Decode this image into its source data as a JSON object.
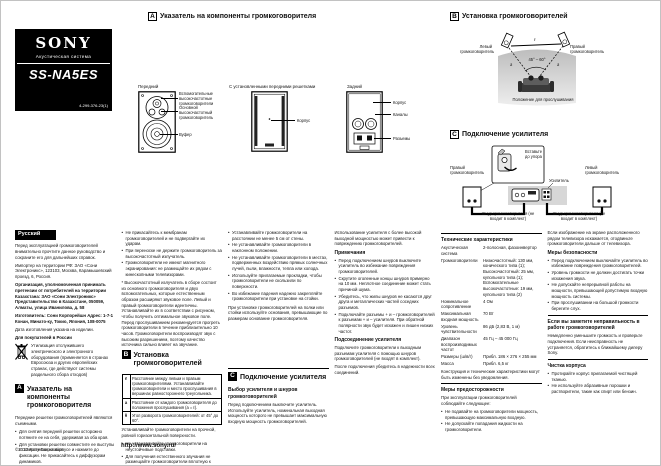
{
  "brand": {
    "logo": "SONY",
    "subtitle": "Акустическая система",
    "model": "SS-NA5ES",
    "part_number": "4-299-376-23(1)"
  },
  "sections": {
    "a": {
      "letter": "A",
      "title": "Указатель на компоненты громкоговорителя"
    },
    "b": {
      "letter": "B",
      "title": "Установка громкоговорителей"
    },
    "c": {
      "letter": "C",
      "title": "Подключение усилителя"
    }
  },
  "diagram_a": {
    "front_caption": "Передний",
    "grille_caption": "С установленными передними решетками",
    "rear_caption": "Задний",
    "label_assist": "Вспомогательные высокочастотные громкоговорители",
    "label_main": "Основной высокочастотный громкоговоритель",
    "label_woofer": "Вуфер",
    "label_cabinet": "Корпус",
    "label_cabinet_rear": "Корпус",
    "label_ducts": "Каналы",
    "label_terminals": "Разъемы"
  },
  "diagram_b": {
    "left_speaker": "Левый громкоговоритель",
    "right_speaker": "Правый громкоговоритель",
    "dist_label": "ℓ",
    "a1": "a",
    "a2": "a",
    "angle": "45° – 60°",
    "caption": "Положение для прослушивания"
  },
  "diagram_c": {
    "left_speaker": "Правый громкоговоритель",
    "right_speaker": "Левый громкоговоритель",
    "amp_label": "Усилитель",
    "inset_label": "Вставьте до упора",
    "cord_left": "Шнур громкоговорителя (не входит в комплект)",
    "cord_right": "Шнур громкоговорителя (не входит в комплект)"
  },
  "col1": {
    "lang": "Русский",
    "p1": "Перед эксплуатацией громкоговорителей внимательно прочтите данное руководство и сохраните его для дальнейших справок.",
    "p2": "Импортер на территории РФ: ЗАО «Сони Электроникс», 123103, Москва, Карамышевский проезд, 6, Россия.",
    "kz": "Организация, уполномоченная принимать претензии от потребителей на территории Казахстана: ЗАО «Сони Электроникс» Представительство в Казахстане, 050059, Алматы, улица Иванилова, д. 58",
    "maker": "Изготовитель: Сони Корпорейшн Адрес: 1-7-1 Конан, Минато-ку, Токио, Япония, 108-0075",
    "made": "Дата изготовления указана на изделии.",
    "russia": "Для покупателей в России",
    "weee": "Утилизация отслужившего электрического и электронного оборудования (применяется в странах Евросоюза и других европейских странах, где действуют системы раздельного сбора отходов)",
    "a_intro": "Передние решетки громкоговорителей являются съемными.",
    "bullets": [
      "Для снятия передней решетки осторожно потяните ее на себя, удерживая за оба края.",
      "Для установки решетки совместите ее выступы с отверстиями на корпусе и нажмите до фиксации. Не прикасайтесь к диффузорам динамиков."
    ]
  },
  "col2": {
    "bullets": [
      "Не прикасайтесь к мембранам громкоговорителей и не подвергайте их ударам.",
      "При переноске не держите громкоговоритель за высокочастотный излучатель.",
      "Громкоговорители не имеют магнитного экранирования: не размещайте их рядом с кинескопными телевизорами."
    ],
    "footnote": "* Высокочастотный излучатель в сборе состоит из основного громкоговорителя и двух вспомогательных, которые естественным образом расширяют звуковое поле. Левый и правый громкоговорители идентичны. Устанавливайте их в соответствии с рисунком, чтобы получить оптимальное звуковое поле. Перед прослушиванием рекомендуется прогреть громкоговорители в течение приблизительно 10 часов. Громкоговорители воспроизводят звук с высоким разрешением, поэтому качество источника сильно влияет на звучание.",
    "table": [
      {
        "key": "ℓ",
        "text": "Расстояние между левым и правым громкоговорителями. Устанавливайте громкоговорители и место прослушивания в вершинах равностороннего треугольника."
      },
      {
        "key": "a",
        "text": "Расстояние от каждого громкоговорителя до положения прослушивания (a = ℓ)."
      },
      {
        "key": "θ",
        "text": "Угол разворота громкоговорителей: от 45° до 60°."
      }
    ],
    "after": "Устанавливайте громкоговорители на прочной, ровной горизонтальной поверхности.",
    "after_bullets": [
      "Не устанавливайте громкоговорители на неустойчивые подставки.",
      "Для получения естественного звучания не размещайте громкоговорители вплотную к стенам и углам комнаты."
    ]
  },
  "col3": {
    "bullets": [
      "Устанавливайте громкоговорители на расстоянии не менее 5 см от стены.",
      "Не устанавливайте громкоговорители в наклонном положении.",
      "Не устанавливайте громкоговорители в местах, подверженных воздействию прямых солнечных лучей, пыли, влажности, тепла или холода.",
      "Используйте прилагаемые прокладки, чтобы громкоговорители не скользили по поверхности.",
      "Во избежание падения надежно закрепляйте громкоговорители при установке на стойки."
    ],
    "para": "При установке громкоговорителей на полки или стойки используйте основания, превышающие по размерам основание громкоговорителя.",
    "sub1": "Выбор усилителя и шнуров громкоговорителей",
    "sub1_text": "Перед подключением выключите усилитель. Используйте усилитель, номинальная выходная мощность которого не превышает максимальную входную мощность громкоговорителей."
  },
  "col4": {
    "p1": "Использование усилителя с более высокой выходной мощностью может привести к повреждению громкоговорителей.",
    "notes_head": "Примечания",
    "notes": [
      "Перед подключением шнуров выключите усилитель во избежание повреждения громкоговорителей.",
      "Скрутите оголенные концы шнуров примерно на 10 мм. Неплотное соединение может стать причиной шума.",
      "Убедитесь, что жилы шнуров не касаются друг друга и металлических частей соседних разъемов.",
      "Подключайте разъемы + и – громкоговорителей к разъемам + и – усилителя. При обратной полярности звук будет искажен и лишен низких частот."
    ],
    "sub2": "Подсоединение усилителя",
    "sub2_text": "Подключите громкоговорители к выходным разъемам усилителя с помощью шнуров громкоговорителей (не входят в комплект).",
    "p2": "После подключения убедитесь в надежности всех соединений."
  },
  "col5": {
    "spec_head": "Технические характеристики",
    "specs": [
      {
        "k": "Акустическая система",
        "v": "2-полосная, фазоинвертор"
      },
      {
        "k": "Громкоговорители",
        "v": "Низкочастотный: 130 мм, конического типа (1); Высокочастотный: 25 мм, купольного типа (1); Вспомогательные высокочастотные: 19 мм, купольного типа (2)"
      },
      {
        "k": "Номинальное сопротивление",
        "v": "4 Ом"
      },
      {
        "k": "Максимальная входная мощность",
        "v": "70 Вт"
      },
      {
        "k": "Уровень чувствительности",
        "v": "86 дБ (2,83 В, 1 м)"
      },
      {
        "k": "Диапазон воспроизводимых частот",
        "v": "45 Гц – 45 000 Гц"
      },
      {
        "k": "Размеры (ш/в/г)",
        "v": "Прибл. 186 × 276 × 255 мм"
      },
      {
        "k": "Масса",
        "v": "Прибл. 6,5 кг"
      }
    ],
    "spec_note": "Конструкция и технические характеристики могут быть изменены без уведомления.",
    "prec_head": "Меры предосторожности",
    "prec_intro": "При эксплуатации громкоговорителей соблюдайте следующее:",
    "prec_bullets": [
      "Не подавайте на громкоговорители мощность, превышающую максимальную входную.",
      "Не допускайте попадания жидкости на громкоговорители."
    ]
  },
  "col6": {
    "p1": "Если изображение на экране расположенного рядом телевизора искажается, отодвиньте громкоговорители дальше от телевизора.",
    "sec1_head": "Меры безопасности",
    "sec1_bullets": [
      "Перед подключением выключайте усилитель во избежание повреждения громкоговорителей.",
      "Уровень громкости не должен достигать точки искажения звука.",
      "Не допускайте непрерывной работы на мощности, превышающей допустимую входную мощность системы.",
      "При прослушивании на большой громкости берегите слух."
    ],
    "sec2_head": "Если вы заметите неправильность в работе громкоговорителей",
    "sec2_text": "Немедленно уменьшите громкость и проверьте подключения. Если неисправность не устраняется, обратитесь к ближайшему дилеру Sony.",
    "sec3_head": "Чистка корпуса",
    "sec3_bullets": [
      "Протирайте корпус прилагаемой чистящей тканью.",
      "Не используйте абразивные порошки и растворители, такие как спирт или бензин."
    ]
  },
  "footer": {
    "copyright": "©2012 Sony Corporation",
    "url": "http://www.sony.ru/"
  }
}
